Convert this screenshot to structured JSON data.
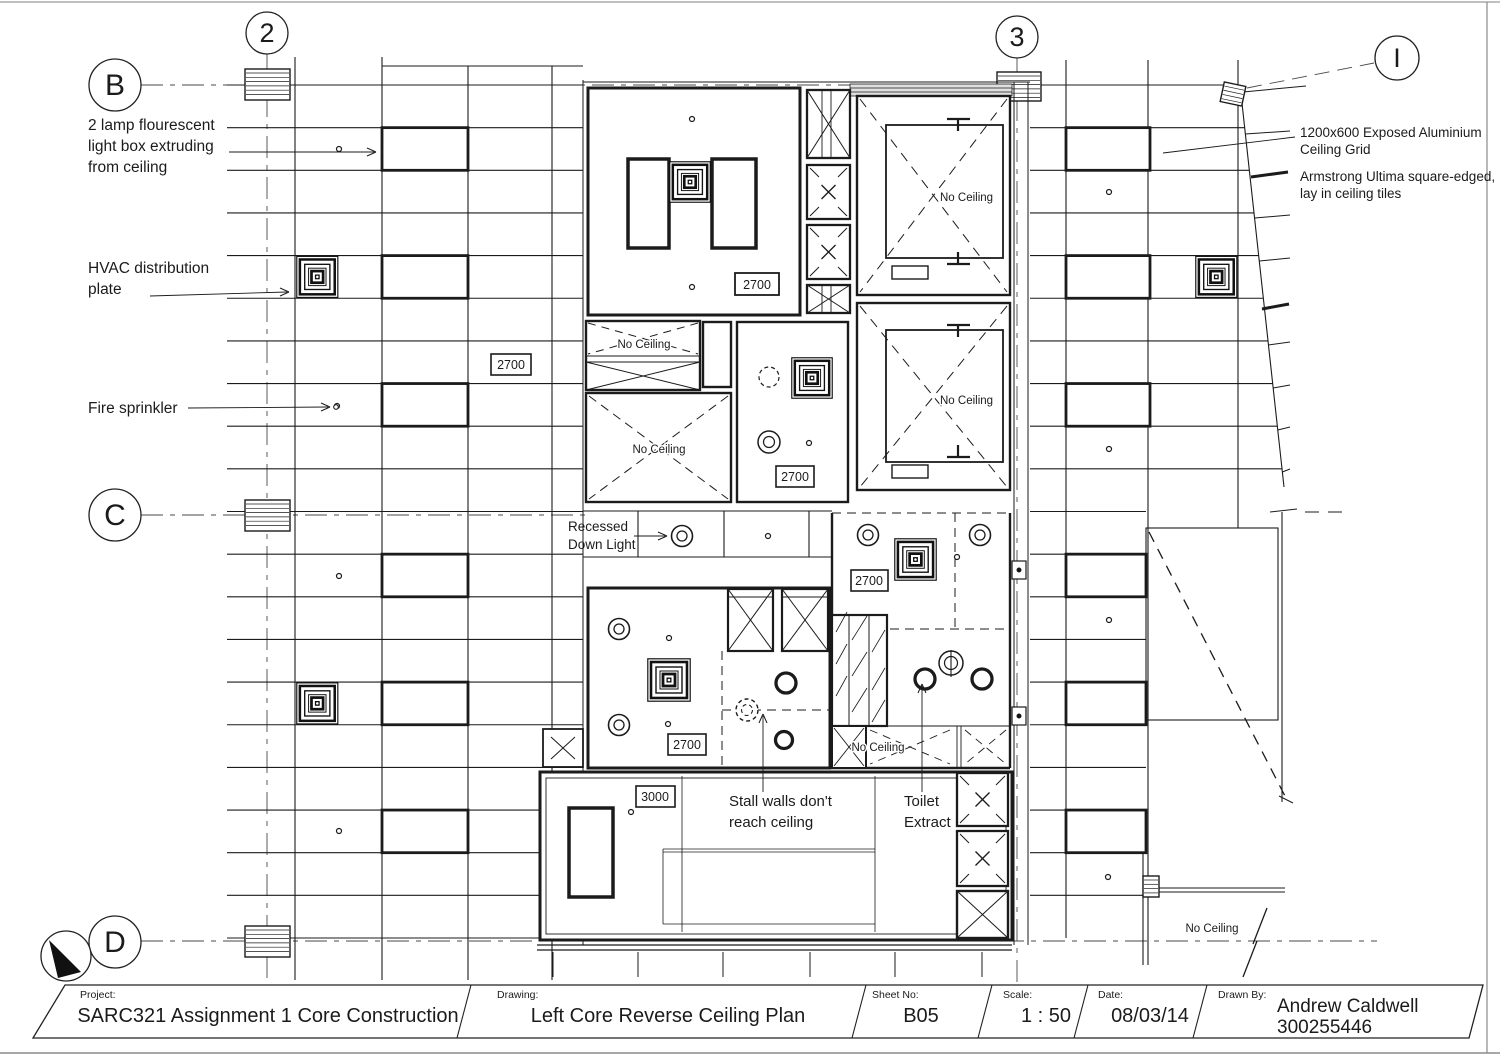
{
  "drawing": {
    "grid_bubbles": {
      "col2": "2",
      "col3": "3",
      "colI": "I",
      "rowB": "B",
      "rowC": "C",
      "rowD": "D"
    },
    "annotations": {
      "lamp_l1": "2 lamp flourescent",
      "lamp_l2": "light box extruding",
      "lamp_l3": "from ceiling",
      "hvac_l1": "HVAC distribution",
      "hvac_l2": "plate",
      "fire": "Fire sprinkler",
      "recessed_l1": "Recessed",
      "recessed_l2": "Down Light",
      "stall_l1": "Stall walls don't",
      "stall_l2": "reach ceiling",
      "toilet_l1": "Toilet",
      "toilet_l2": "Extract",
      "grid_note_l1": "1200x600 Exposed Aluminium",
      "grid_note_l2": "Ceiling Grid",
      "tile_note_l1": "Armstrong Ultima square-edged,",
      "tile_note_l2": "lay in ceiling tiles",
      "no_ceiling": "No Ceiling"
    },
    "height_labels": {
      "h2700": "2700",
      "h3000": "3000"
    }
  },
  "title_block": {
    "project_label": "Project:",
    "project": "SARC321 Assignment 1 Core Construction",
    "drawing_label": "Drawing:",
    "drawing": "Left Core Reverse Ceiling Plan",
    "sheet_label": "Sheet No:",
    "sheet": "B05",
    "scale_label": "Scale:",
    "scale": "1 : 50",
    "date_label": "Date:",
    "date": "08/03/14",
    "drawn_label": "Drawn By:",
    "drawn_name": "Andrew Caldwell",
    "drawn_id": "300255446"
  }
}
